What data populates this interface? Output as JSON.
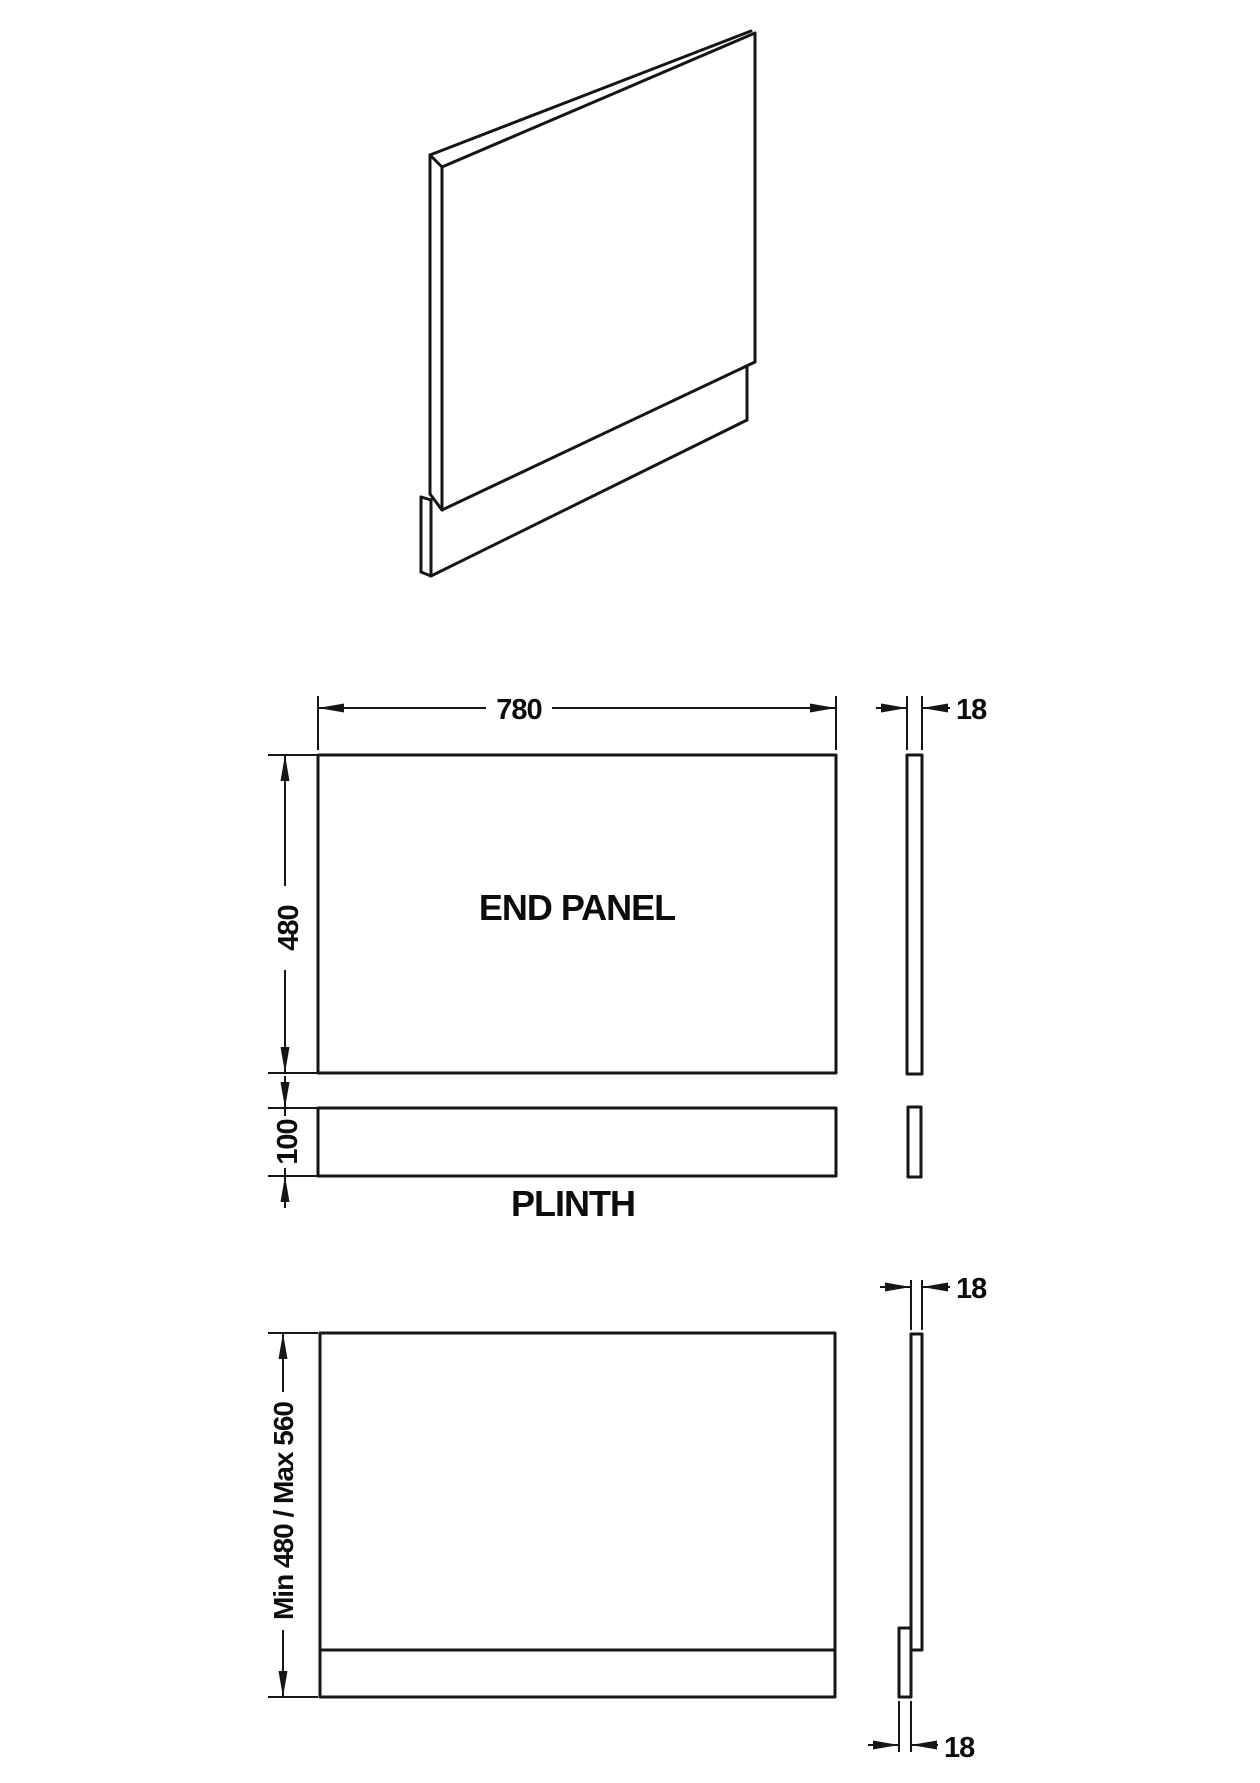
{
  "page": {
    "background": "#ffffff",
    "line_color": "#161616"
  },
  "exploded_view": {
    "panel_width": "780",
    "panel_height": "480",
    "panel_label": "END PANEL",
    "plinth_height": "100",
    "plinth_label": "PLINTH",
    "panel_thickness": "18"
  },
  "assembled_view": {
    "height_range": "Min 480 / Max 560",
    "panel_thickness": "18",
    "plinth_thickness": "18"
  }
}
